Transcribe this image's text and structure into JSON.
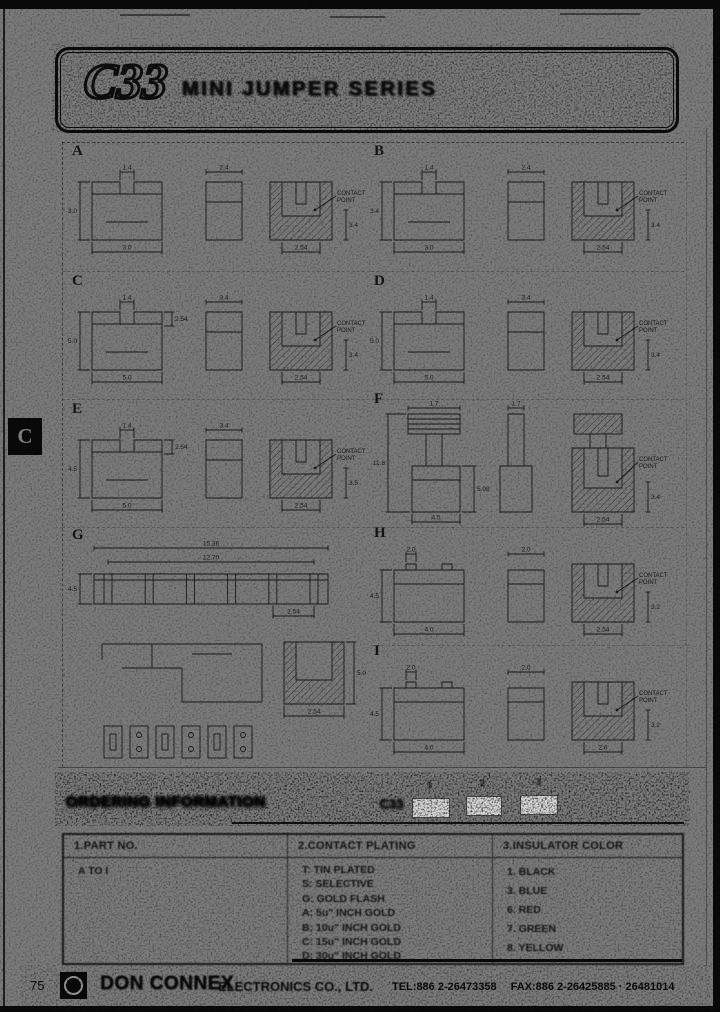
{
  "tab": {
    "letter": "C"
  },
  "header": {
    "code": "C33",
    "title": "MINI JUMPER SERIES"
  },
  "drawings": {
    "contact_point_label": "CONTACT POINT",
    "sections": [
      {
        "letter": "A",
        "variant": "std",
        "x": 66,
        "y": 146,
        "front": {
          "top": "1.4",
          "left": "3.0",
          "bottom": "3.0"
        },
        "side": {
          "top": "2.4"
        },
        "section": {
          "depth": "3.4",
          "pitch": "2.54"
        }
      },
      {
        "letter": "B",
        "variant": "std",
        "x": 368,
        "y": 146,
        "front": {
          "top": "1.4",
          "left": "3.4",
          "bottom": "3.0"
        },
        "side": {
          "top": "2.4"
        },
        "section": {
          "depth": "3.4",
          "pitch": "2.54"
        }
      },
      {
        "letter": "C",
        "variant": "std",
        "x": 66,
        "y": 276,
        "front": {
          "top": "1.4",
          "left": "5.0",
          "bottom": "5.0",
          "mid": "2.54"
        },
        "side": {
          "top": "3.4"
        },
        "section": {
          "depth": "3.4",
          "pitch": "2.54"
        }
      },
      {
        "letter": "D",
        "variant": "std",
        "x": 368,
        "y": 276,
        "front": {
          "top": "1.4",
          "left": "5.0",
          "bottom": "5.0"
        },
        "side": {
          "top": "3.4"
        },
        "section": {
          "depth": "3.4",
          "pitch": "2.54"
        }
      },
      {
        "letter": "E",
        "variant": "std",
        "x": 66,
        "y": 404,
        "front": {
          "top": "1.4",
          "left": "4.5",
          "bottom": "5.0",
          "mid": "2.54"
        },
        "side": {
          "top": "3.4"
        },
        "section": {
          "depth": "3.5",
          "pitch": "2.54"
        }
      },
      {
        "letter": "F",
        "variant": "tall",
        "x": 368,
        "y": 394,
        "front": {
          "top": "1.7",
          "left": "11.8",
          "right": "5.08",
          "bottom": "4.5"
        },
        "side": {
          "top": "1.7"
        },
        "section": {
          "depth": "3.4",
          "pitch": "2.54"
        }
      },
      {
        "letter": "G",
        "variant": "wide",
        "x": 66,
        "y": 530,
        "front": {
          "overall": "15.36",
          "inner": "12.70",
          "left": "4.5",
          "pitch": "2.54"
        }
      },
      {
        "letter": "H",
        "variant": "std",
        "x": 368,
        "y": 528,
        "front": {
          "top": "2.0",
          "left": "4.5",
          "bottom": "4.0"
        },
        "side": {
          "top": "2.0"
        },
        "section": {
          "depth": "3.2",
          "pitch": "2.54"
        }
      },
      {
        "letter": "I",
        "variant": "std",
        "x": 368,
        "y": 646,
        "front": {
          "top": "2.0",
          "left": "4.5",
          "bottom": "4.0"
        },
        "side": {
          "top": "2.0"
        },
        "section": {
          "depth": "3.2",
          "pitch": "2.6"
        }
      }
    ],
    "g_extra": {
      "x": 92,
      "y": 618,
      "side_height": "5.0",
      "pitch": "2.54"
    }
  },
  "ordering": {
    "title": "ORDERING INFORMATION",
    "series": "C33",
    "positions": [
      "1",
      "2",
      "3"
    ]
  },
  "table": {
    "columns": [
      {
        "header": "1.PART NO.",
        "items": [
          "A TO I"
        ]
      },
      {
        "header": "2.CONTACT PLATING",
        "items": [
          "T: TIN PLATED",
          "S: SELECTIVE",
          "G: GOLD FLASH",
          "A: 5u\" INCH GOLD",
          "B: 10u\" INCH GOLD",
          "C: 15u\" INCH GOLD",
          "D: 30u\" INCH GOLD"
        ]
      },
      {
        "header": "3.INSULATOR COLOR",
        "items": [
          "1. BLACK",
          "3. BLUE",
          "6. RED",
          "7. GREEN",
          "8. YELLOW"
        ]
      }
    ]
  },
  "footer": {
    "page_number": "75",
    "company": "DON CONNEX",
    "company_suffix": "ELECTRONICS CO., LTD.",
    "tel": "TEL:886 2-26473358",
    "fax": "FAX:886 2-26425885 · 26481014"
  }
}
